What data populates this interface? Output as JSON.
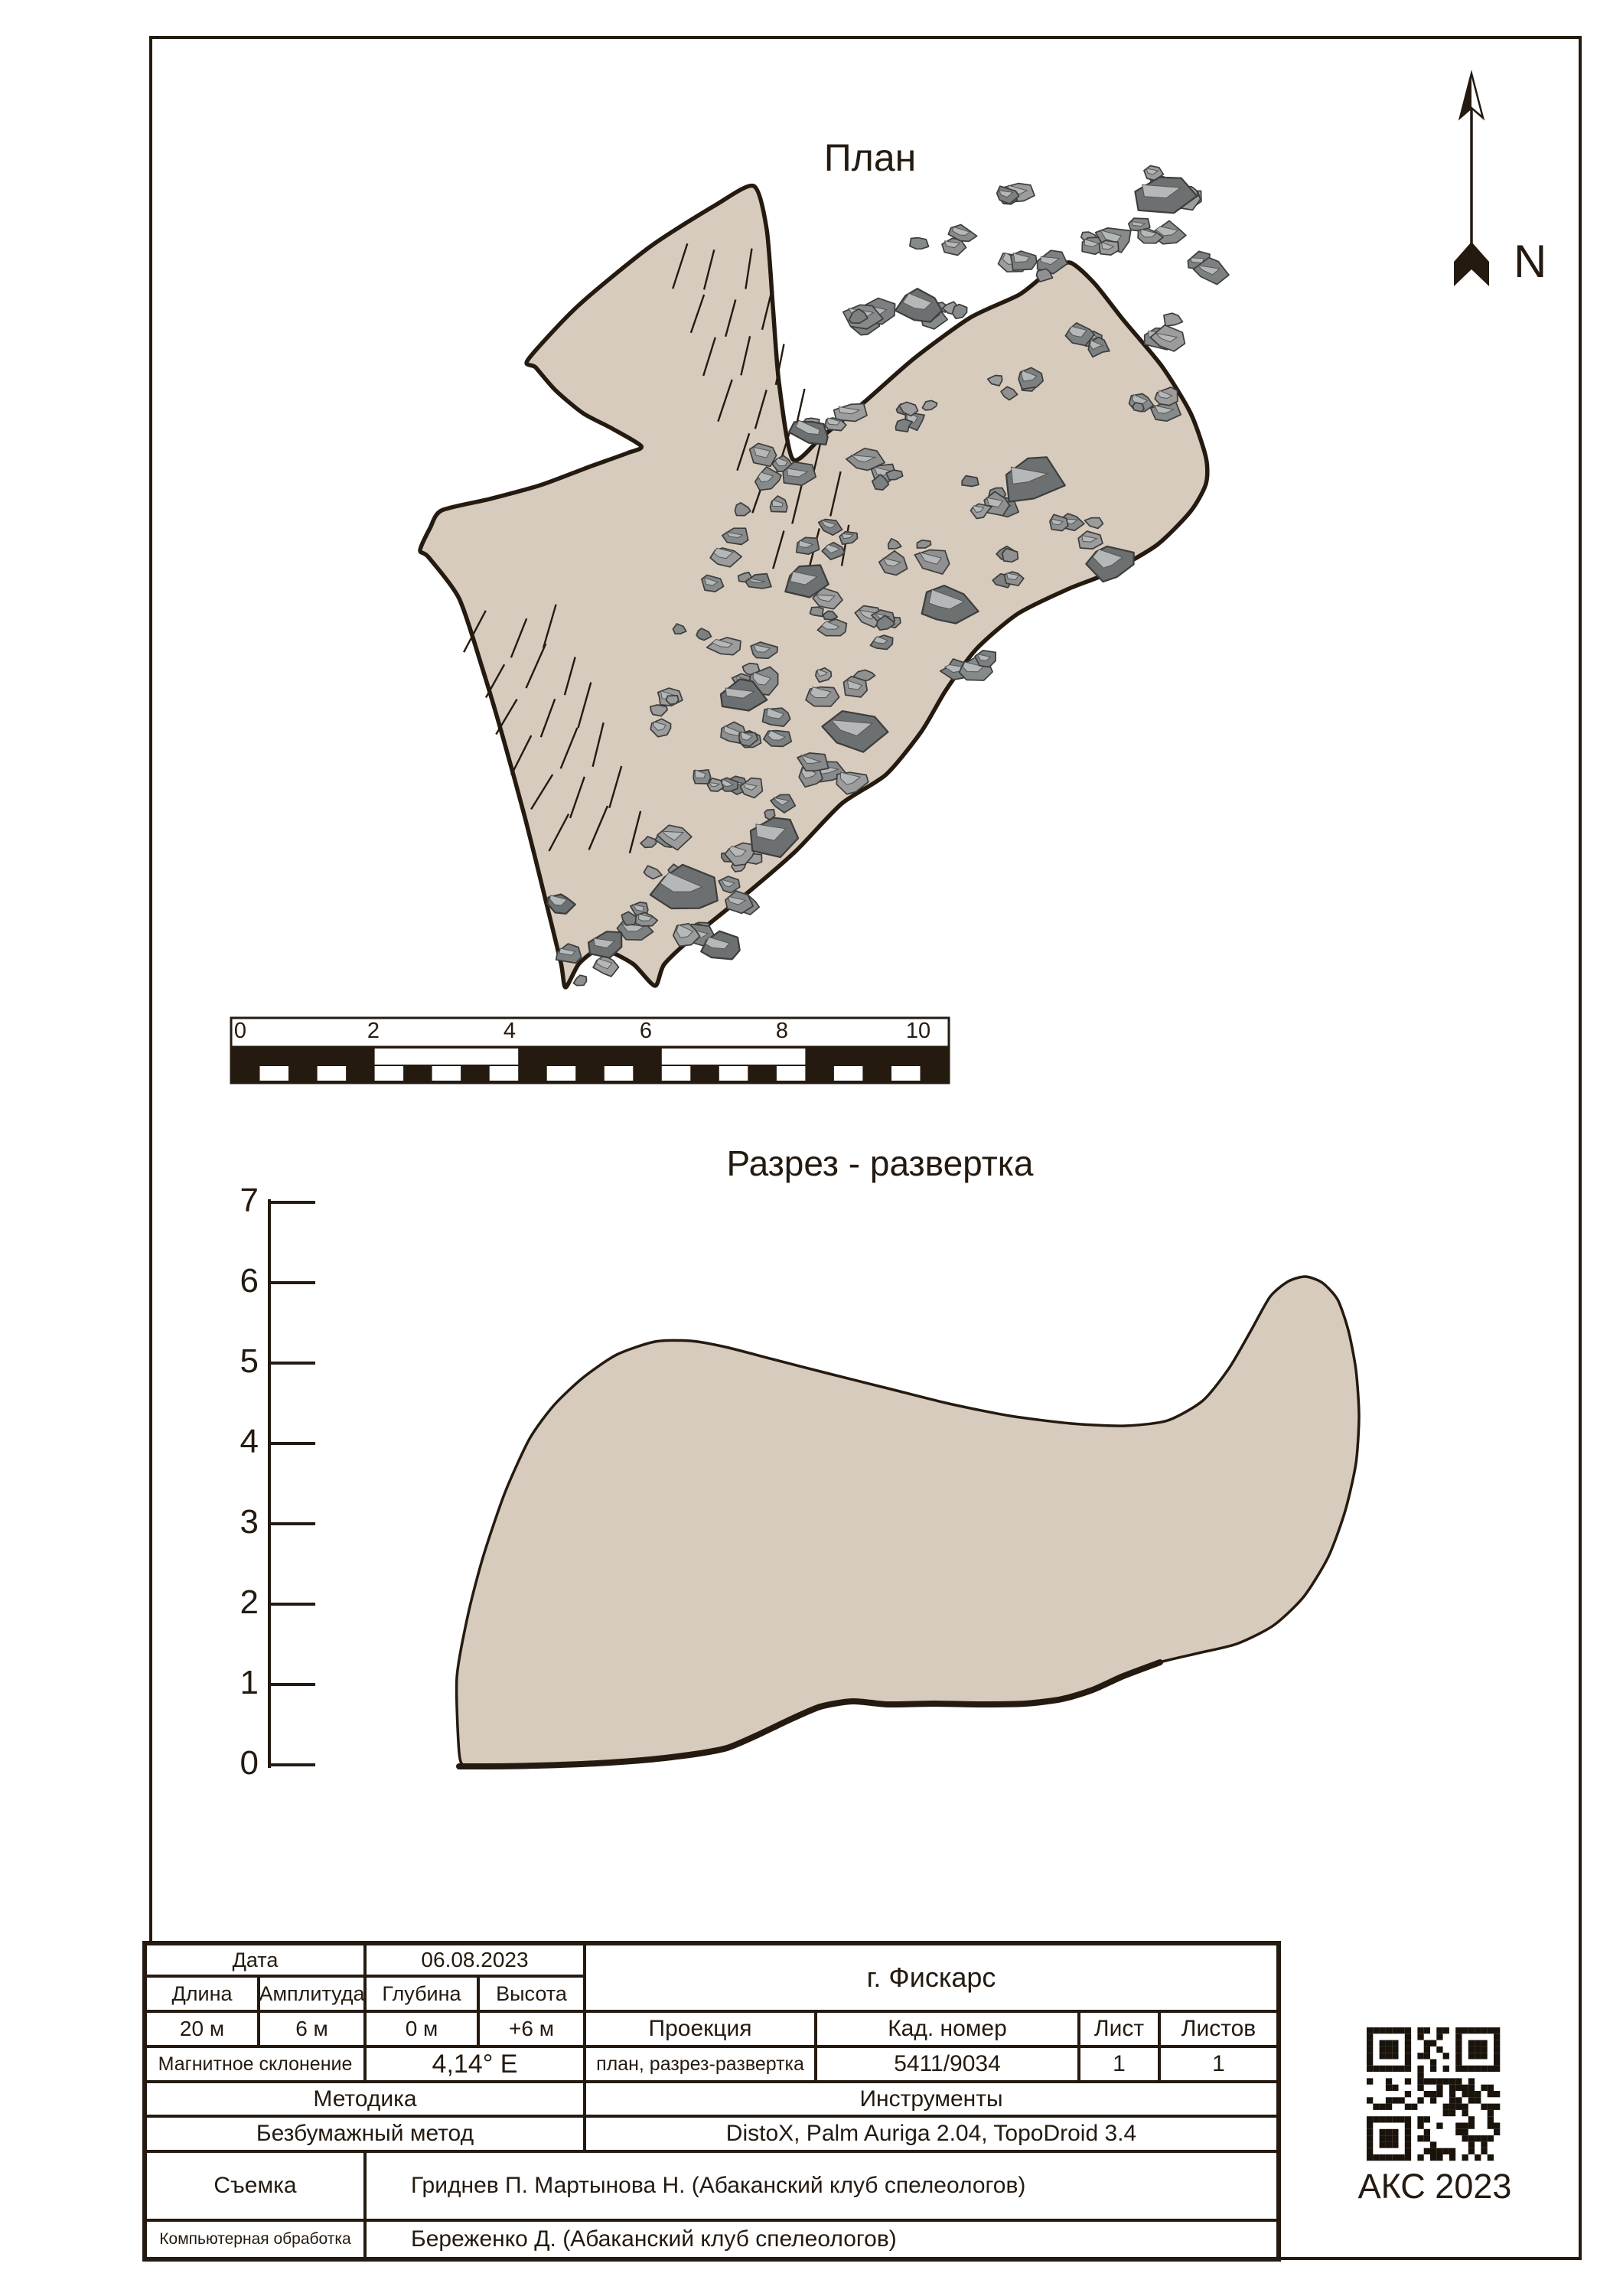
{
  "titles": {
    "plan": "План",
    "section": "Разрез - развертка"
  },
  "north": {
    "label": "N"
  },
  "scale_bar": {
    "labels": [
      "0",
      "2",
      "4",
      "6",
      "8",
      "10"
    ]
  },
  "section_axis": {
    "labels": [
      "7",
      "6",
      "5",
      "4",
      "3",
      "2",
      "1",
      "0"
    ],
    "min_m": 0,
    "max_m": 7
  },
  "stamp": {
    "text": "АКС 2023"
  },
  "table": {
    "date_label": "Дата",
    "date_value": "06.08.2023",
    "cave_name": "г. Фискарс",
    "length_label": "Длина",
    "amplitude_label": "Амплитуда",
    "depth_label": "Глубина",
    "height_label": "Высота",
    "length_value": "20 м",
    "amplitude_value": "6 м",
    "depth_value": "0 м",
    "height_value": "+6 м",
    "projection_label": "Проекция",
    "cad_label": "Кад. номер",
    "sheet_label": "Лист",
    "sheets_label": "Листов",
    "magnetic_label": "Магнитное склонение",
    "magnetic_value": "4,14° E",
    "projection_value": "план, разрез-развертка",
    "cad_value": "5411/9034",
    "sheet_value": "1",
    "sheets_value": "1",
    "method_label": "Методика",
    "instruments_label": "Инструменты",
    "method_value": "Безбумажный метод",
    "instruments_value": "DistoX, Palm Auriga 2.04, TopoDroid 3.4",
    "survey_label": "Съемка",
    "survey_value": "Гриднев П. Мартынова Н. (Абаканский клуб спелеологов)",
    "processing_label": "Компьютерная обработка",
    "processing_value": "Береженко Д. (Абаканский клуб спелеологов)"
  },
  "colors": {
    "ink": "#241a10",
    "cave_fill": "#d7cbbd",
    "rock": "#909090",
    "rock_light": "#b4b8b8",
    "rock_dark": "#6d7070",
    "paper": "#ffffff"
  }
}
